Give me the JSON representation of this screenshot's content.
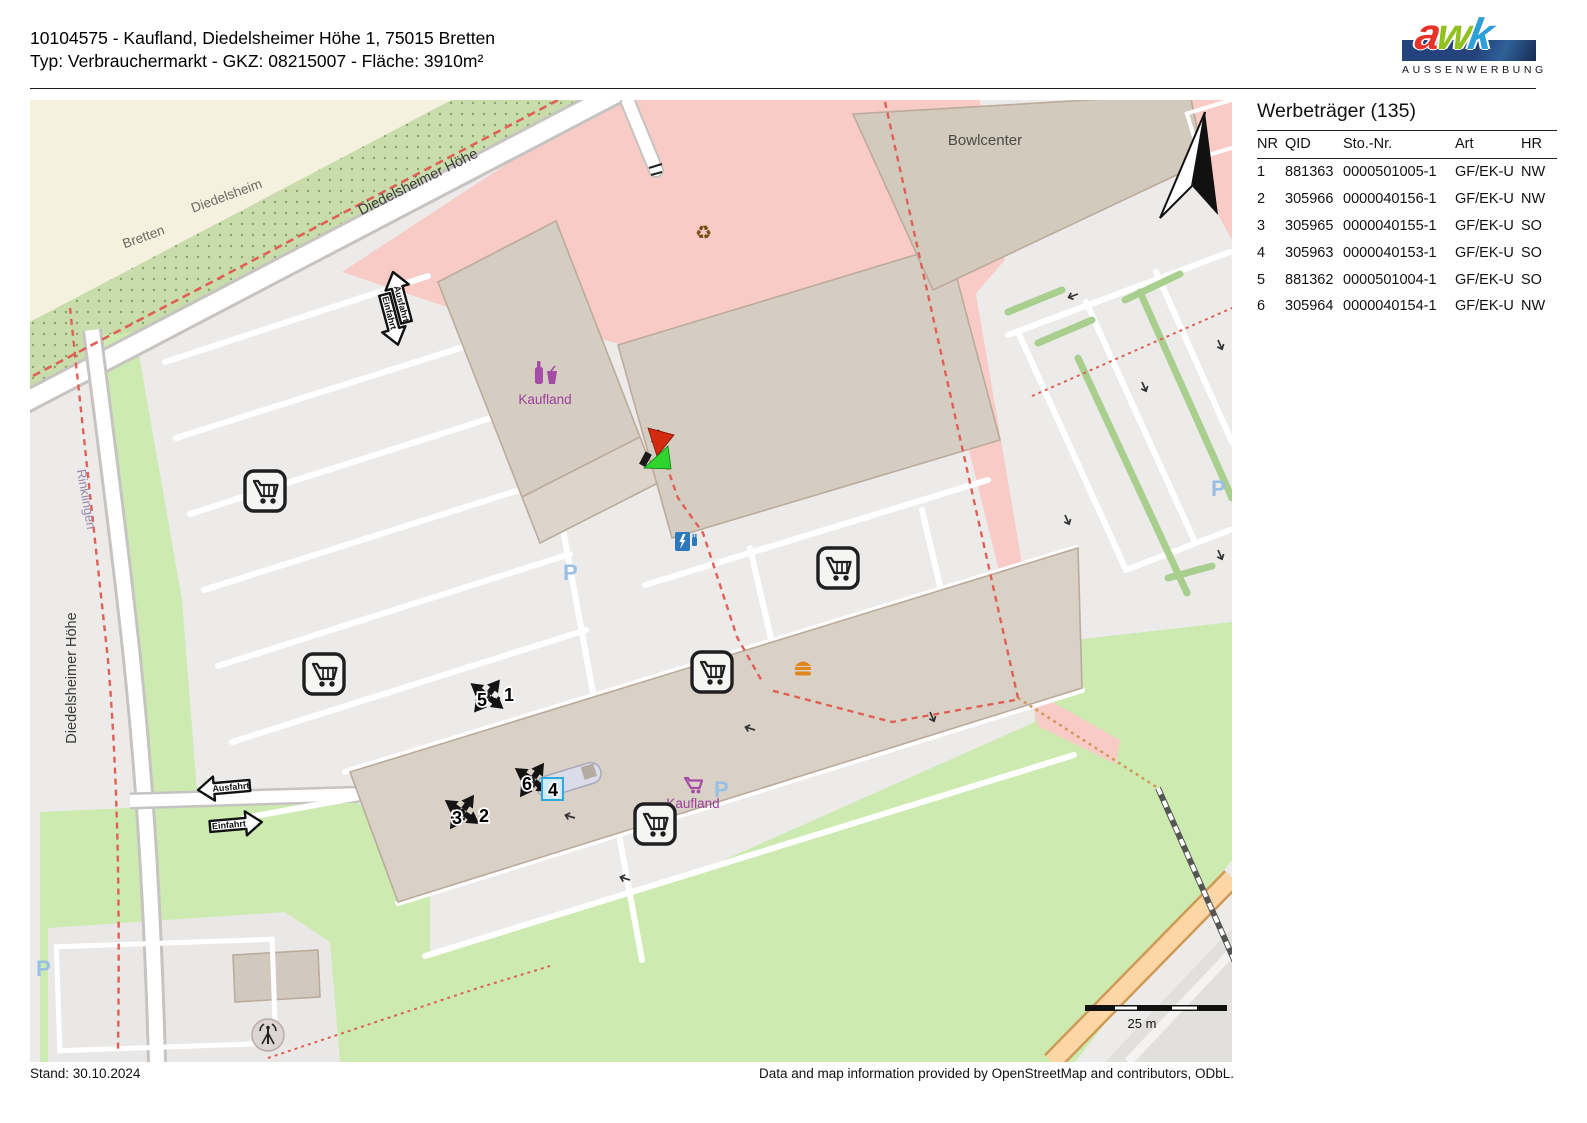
{
  "header": {
    "line1": "10104575 - Kaufland, Diedelsheimer Höhe 1, 75015 Bretten",
    "line2": "Typ: Verbrauchermarkt - GKZ: 08215007 - Fläche: 3910m²"
  },
  "logo": {
    "letters": [
      {
        "ch": "a",
        "color": "#e6332a"
      },
      {
        "ch": "w",
        "color": "#91c11e"
      },
      {
        "ch": "k",
        "color": "#2f9fd8"
      }
    ],
    "subtitle": "AUSSENWERBUNG"
  },
  "panel": {
    "title": "Werbeträger (135)",
    "columns": [
      "NR",
      "QID",
      "Sto.-Nr.",
      "Art",
      "HR"
    ],
    "rows": [
      [
        "1",
        "881363",
        "0000501005-1",
        "GF/EK-U",
        "NW"
      ],
      [
        "2",
        "305966",
        "0000040156-1",
        "GF/EK-U",
        "NW"
      ],
      [
        "3",
        "305965",
        "0000040155-1",
        "GF/EK-U",
        "SO"
      ],
      [
        "4",
        "305963",
        "0000040153-1",
        "GF/EK-U",
        "SO"
      ],
      [
        "5",
        "881362",
        "0000501004-1",
        "GF/EK-U",
        "SO"
      ],
      [
        "6",
        "305964",
        "0000040154-1",
        "GF/EK-U",
        "NW"
      ]
    ]
  },
  "map": {
    "streets": {
      "diagonal": "Diedelsheimer Höhe",
      "vertical": "Diedelsheimer Höhe"
    },
    "districts": {
      "north": "Diedelsheim",
      "south": "Bretten",
      "west": "Rinklingen"
    },
    "pois": {
      "bowlcenter": "Bowlcenter",
      "kaufland": "Kaufland",
      "parking": "P",
      "recycling": "♻"
    },
    "signs": {
      "exit": "Ausfahrt",
      "entry": "Einfahrt"
    },
    "markers": {
      "group1": {
        "on": "5",
        "pair": "1"
      },
      "group2": {
        "on": "6",
        "pair": "4"
      },
      "group3": {
        "on": "3",
        "pair": "2"
      }
    },
    "scale_label": "25 m"
  },
  "footer": {
    "stand": "Stand: 30.10.2024",
    "attribution": "Data and map information provided by OpenStreetMap and contributors, ODbL."
  },
  "colors": {
    "retail_pink": "#f8cbc7",
    "grass_green": "#cdeab0",
    "scrub_green": "#c9dcab",
    "building_tan": "#d6cdc2",
    "road_orange": "#fcd6a4",
    "boundary_red": "#e06055",
    "parking_blue": "#98bfe5",
    "poi_purple": "#a04ba0",
    "selection_blue": "#2fa8dd"
  }
}
